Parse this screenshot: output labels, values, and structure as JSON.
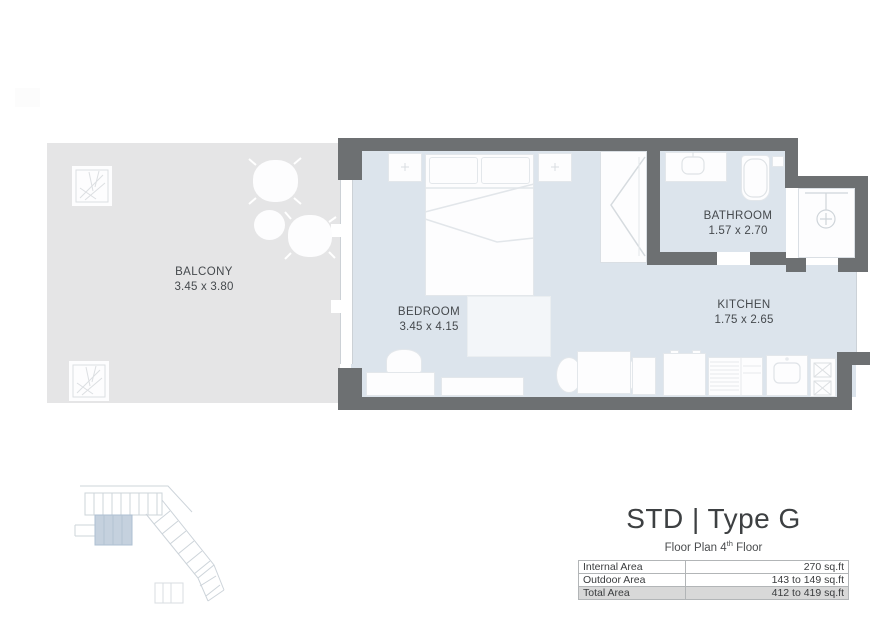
{
  "plan": {
    "rooms": [
      {
        "name": "BALCONY",
        "dims": "3.45 x 3.80"
      },
      {
        "name": "BEDROOM",
        "dims": "3.45 x 4.15"
      },
      {
        "name": "BATHROOM",
        "dims": "1.57 x 2.70"
      },
      {
        "name": "KITCHEN",
        "dims": "1.75 x 2.65"
      }
    ],
    "icons": [
      "plant-icon",
      "patio-chair-icon",
      "patio-table-icon",
      "bed-icon",
      "closet-doors-icon",
      "shower-icon",
      "bathtub-icon",
      "vanity-sink-icon",
      "stove-burners-icon",
      "kitchen-sink-icon",
      "fridge-icon",
      "dining-table-icon"
    ]
  },
  "title_block": {
    "title": "STD | Type G",
    "subtitle_prefix": "Floor Plan 4",
    "subtitle_sup": "th",
    "subtitle_suffix": " Floor",
    "table": {
      "rows": [
        {
          "label": "Internal Area",
          "value": "270 sq.ft"
        },
        {
          "label": "Outdoor Area",
          "value": "143 to 149 sq.ft"
        },
        {
          "label": "Total Area",
          "value": "412 to 419 sq.ft"
        }
      ]
    }
  },
  "colors": {
    "wall": "#6d7072",
    "interior_floor": "#dce4ec",
    "balcony_floor": "#e5e5e6",
    "table_highlight_row": "#d8d8d8",
    "keyplan_highlight": "#c5d1de"
  }
}
